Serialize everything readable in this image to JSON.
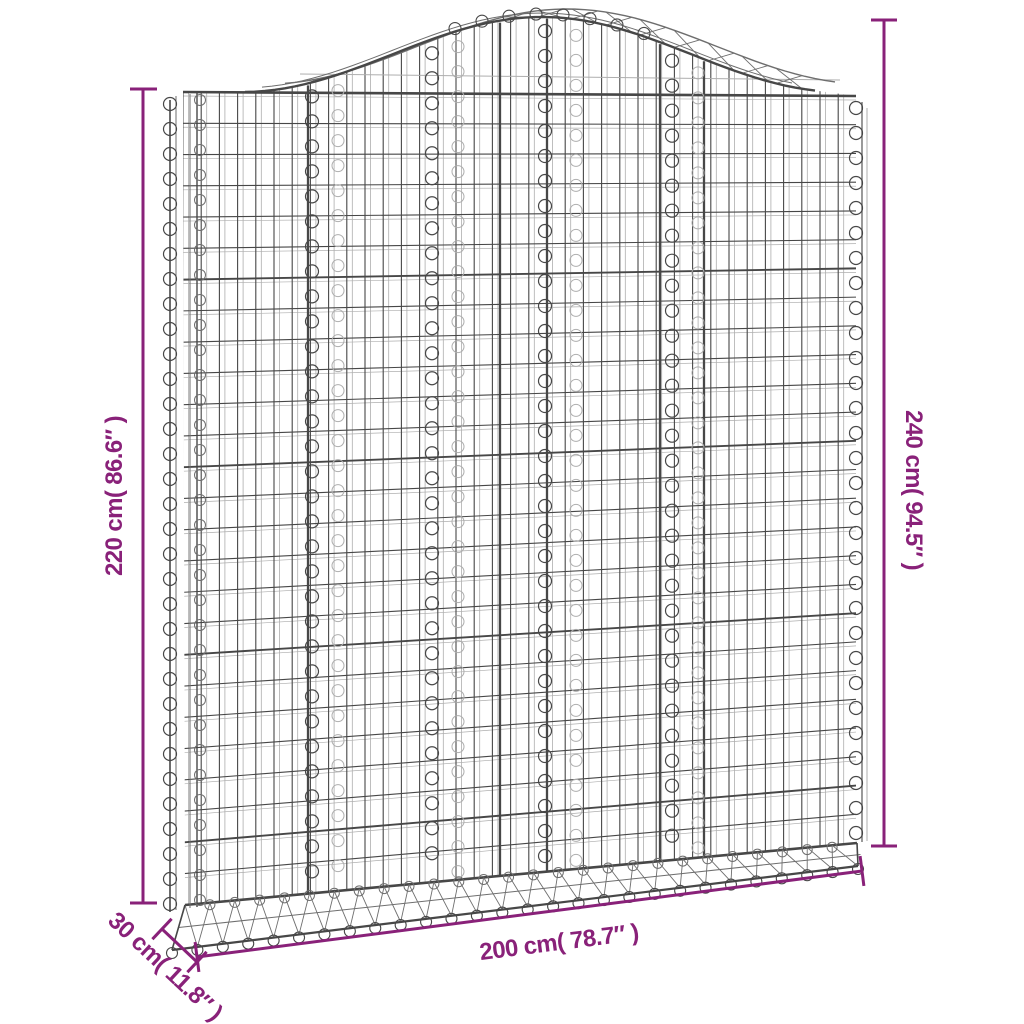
{
  "product_illustration": {
    "subject": "arched-gabion-basket",
    "material_look": "galvanised-wire-mesh"
  },
  "colors": {
    "accent": "#892179",
    "background": "#ffffff",
    "wire_dark": "#474747",
    "wire_mid": "#6e6e6e",
    "wire_light": "#aeaeae"
  },
  "dimensions": {
    "left_height": {
      "label": "220 cm( 86.6″ )"
    },
    "right_height": {
      "label": "240 cm( 94.5″ )"
    },
    "width": {
      "label": "200 cm( 78.7″ )"
    },
    "depth": {
      "label": "30 cm( 11.8″ )"
    }
  }
}
